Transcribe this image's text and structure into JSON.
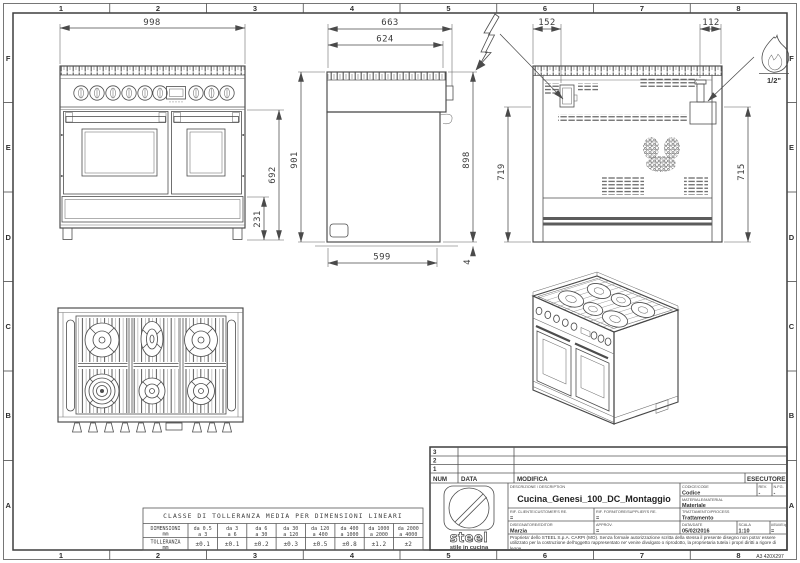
{
  "sheet": {
    "zone_numbers": [
      "1",
      "2",
      "3",
      "4",
      "5",
      "6",
      "7",
      "8"
    ],
    "zone_letters": [
      "F",
      "E",
      "D",
      "C",
      "B",
      "A"
    ],
    "format_label": "A3 420X297"
  },
  "dimensions": {
    "front": {
      "width": "998",
      "height": "692",
      "plinth": "231"
    },
    "side": {
      "depth_total": "663",
      "depth_body": "624",
      "height_front": "901",
      "height_back": "898",
      "depth_base": "599",
      "base_gap": "4"
    },
    "back": {
      "elec_offset": "152",
      "gas_offset": "112",
      "height_left": "719",
      "height_right": "715"
    },
    "gas_connection": "1/2\""
  },
  "tolerance_table": {
    "title": "CLASSE DI TOLLERANZA MEDIA PER DIMENSIONI LINEARI",
    "dim_label": "DIMENSIONI",
    "dim_unit": "mm",
    "tol_label": "TOLLERANZA",
    "tol_unit": "mm",
    "ranges": [
      {
        "da": "da 0.5",
        "a": "a 3"
      },
      {
        "da": "da 3",
        "a": "a 6"
      },
      {
        "da": "da 6",
        "a": "a 30"
      },
      {
        "da": "da 30",
        "a": "a 120"
      },
      {
        "da": "da 120",
        "a": "a 400"
      },
      {
        "da": "da 400",
        "a": "a 1000"
      },
      {
        "da": "da 1000",
        "a": "a 2000"
      },
      {
        "da": "da 2000",
        "a": "a 4000"
      }
    ],
    "tolerances": [
      "±0.1",
      "±0.1",
      "±0.2",
      "±0.3",
      "±0.5",
      "±0.8",
      "±1.2",
      "±2"
    ]
  },
  "title_block": {
    "revision_rows": [
      "3",
      "2",
      "1"
    ],
    "num_header": "NUM",
    "data_header": "DATA",
    "modifica_header": "MODIFICA",
    "esecutore_header": "ESECUTORE",
    "description_label": "DESCRIZIONE / DESCRIPTION",
    "description": "Cucina_Genesi_100_DC_Montaggio",
    "code_label": "CODICE/CODE",
    "code_value": "Codice",
    "rev_label": "REV.",
    "rev_value": "-",
    "sheet_no_label": "N.FG.",
    "sheet_no_value": "-",
    "material_label": "MATERIALE/MATERIAL",
    "material_value": "Materiale",
    "customer_ref_label": "RIF. CLIENTE/CUSTOMER'S RE.",
    "customer_ref_value": "=",
    "supplier_ref_label": "RIF. FORNITORE/SUPPLIER'S RE.",
    "supplier_ref_value": "=",
    "process_label": "TRATTAMENTO/PROCESS",
    "process_value": "Trattamento",
    "editor_label": "DISEGNATORE/EDITOR",
    "editor_value": "Marzia",
    "approval_label": "APPROV.",
    "approval_value": "=",
    "date_label": "DATA/DATE",
    "date_value": "05/02/2016",
    "scale_label": "SCALA",
    "scale_value": "1:10",
    "mass_label": "MASSA/MASS kg",
    "mass_value": "=",
    "logo_brand": "steel",
    "logo_tagline": "stile in cucina",
    "copyright": "Proprieta' dello STEEL S.p.A. CARPI (MO). Senza formale autorizzazione scritta della stessa il presente disegno non potra' essere utilizzato per la costruzione dell'oggetto rappresentato ne' venire divulgato o riprodotto, la proprietaria tutela i propri diritti a rigore di legge."
  }
}
